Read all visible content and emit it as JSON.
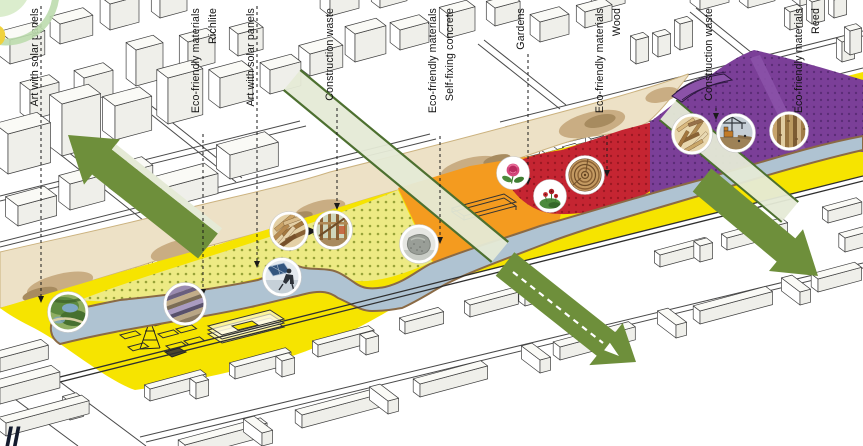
{
  "labels": [
    {
      "text": "Art with solar panels"
    },
    {
      "text": "Eco-friendly materials",
      "sub": "Richlite"
    },
    {
      "text": "Art with solar panels"
    },
    {
      "text": "Construction waste"
    },
    {
      "text": "Eco-friendly materials",
      "sub": "Self-fixing concrete"
    },
    {
      "text": "Gardens"
    },
    {
      "text": "Eco-friendly materials",
      "sub": "Wood"
    },
    {
      "text": "Construction waste"
    },
    {
      "text": "Eco-friendly materials",
      "sub": "Reed"
    }
  ],
  "watermark": "ll",
  "insets": [
    {
      "name": "park-landscape"
    },
    {
      "name": "richlite-layered-material"
    },
    {
      "name": "person-with-solar-panel"
    },
    {
      "name": "reclaimed-wood-scraps"
    },
    {
      "name": "timber-frame-structure"
    },
    {
      "name": "self-fixing-concrete-sample"
    },
    {
      "name": "rose"
    },
    {
      "name": "garden-flowers"
    },
    {
      "name": "wood-log-end-grain"
    },
    {
      "name": "wood-chips"
    },
    {
      "name": "construction-site"
    },
    {
      "name": "reed-stalks"
    }
  ],
  "colors": {
    "yellow": "#F6E400",
    "yellow_dotted": "#EDEA84",
    "orange": "#F49B1F",
    "red": "#C52532",
    "purple": "#7B3F98",
    "river": "#AFC3D2",
    "sand": "#EDE1C6",
    "sand_blob": "#C9AD83",
    "green": "#6E8F3B",
    "pale_green": "#E5EAD6",
    "ink": "#1A1A1A"
  }
}
